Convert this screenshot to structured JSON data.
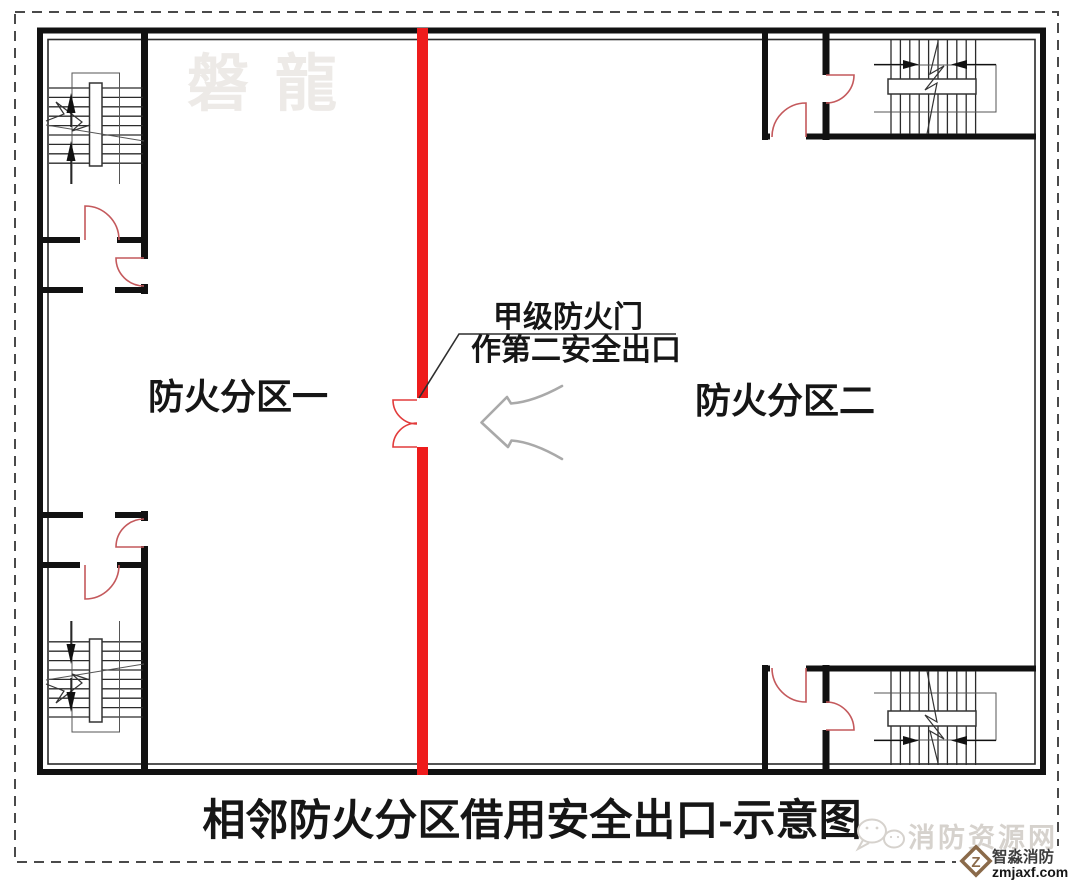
{
  "diagram": {
    "watermark_top": "磐龍",
    "zone_left_label": "防火分区一",
    "zone_right_label": "防火分区二",
    "door_note_line1": "甲级防火门",
    "door_note_line2": "作第二安全出口",
    "title": "相邻防火分区借用安全出口-示意图"
  },
  "footer_watermark": {
    "site_name": "消防资源网",
    "brand_name": "智淼消防",
    "brand_domain": "zmjaxf.com",
    "logo_letter": "Z"
  },
  "colors": {
    "fire_wall_red": "#ee1c1c",
    "fire_door_red": "#e23b3b",
    "door_swing_red": "#c4595c",
    "guide_arrow_gray": "#a9a9a9",
    "leader_black": "#2f2f2f",
    "watermark_light_gray": "#d6d2cd",
    "brand_bronze": "#8a6a4a"
  }
}
